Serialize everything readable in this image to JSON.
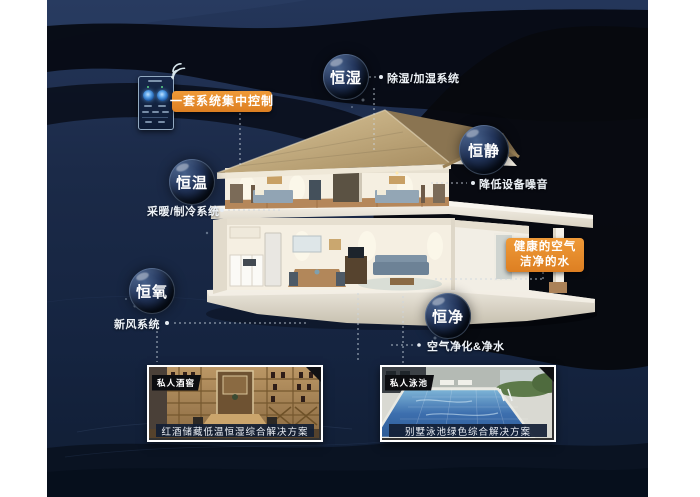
{
  "colors": {
    "accent_orange": "#e5862b",
    "background_navy": "#16253f",
    "dark_wave": "#07090f",
    "bubble_sphere": "#0d1830",
    "connector_gray": "#ccd6e0"
  },
  "callouts": {
    "central_control": "一套系统集中控制",
    "healthy_air_line1": "健康的空气",
    "healthy_air_line2": "洁净的水"
  },
  "bubbles": [
    {
      "label": "恒湿",
      "desc": "除湿/加湿系统"
    },
    {
      "label": "恒静",
      "desc": "降低设备噪音"
    },
    {
      "label": "恒温",
      "desc": "采暖/制冷系统"
    },
    {
      "label": "恒氧",
      "desc": "新风系统"
    },
    {
      "label": "恒净",
      "desc": "空气净化&净水"
    }
  ],
  "photos": [
    {
      "tag": "私人酒窖",
      "caption": "红酒储藏低温恒湿综合解决方案"
    },
    {
      "tag": "私人泳池",
      "caption": "别墅泳池绿色综合解决方案"
    }
  ],
  "icons": {
    "wifi": "wifi-icon"
  }
}
